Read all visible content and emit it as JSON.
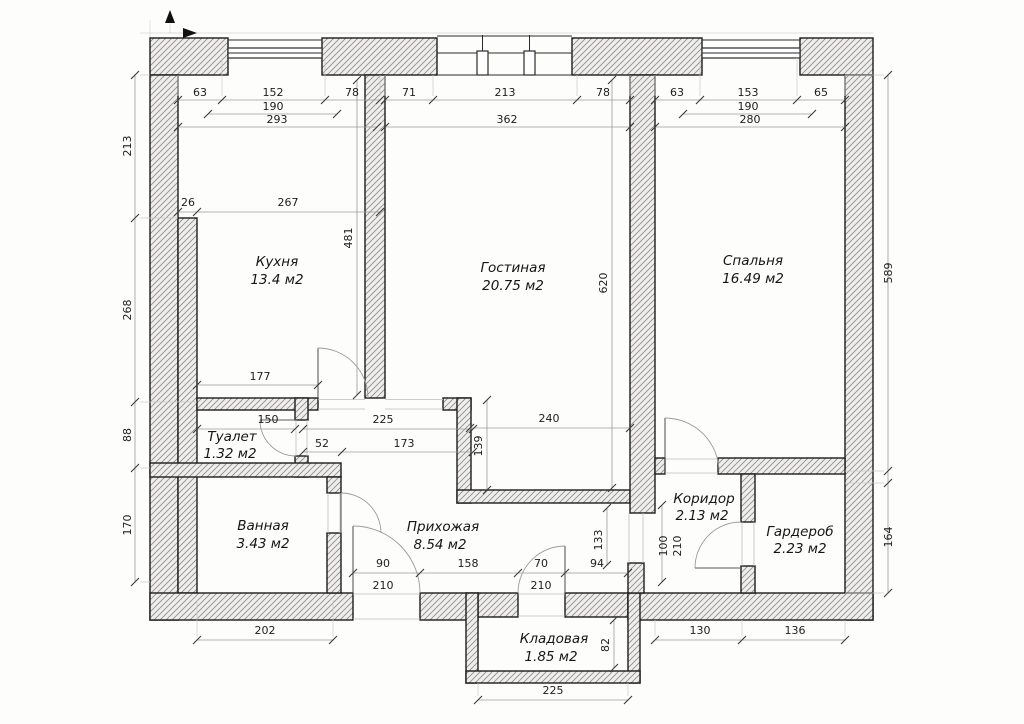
{
  "rooms": {
    "kitchen": {
      "name": "Кухня",
      "area": "13.4 м2"
    },
    "living": {
      "name": "Гостиная",
      "area": "20.75 м2"
    },
    "bedroom": {
      "name": "Спальня",
      "area": "16.49 м2"
    },
    "toilet": {
      "name": "Туалет",
      "area": "1.32 м2"
    },
    "bath": {
      "name": "Ванная",
      "area": "3.43 м2"
    },
    "hall": {
      "name": "Прихожая",
      "area": "8.54 м2"
    },
    "corridor": {
      "name": "Коридор",
      "area": "2.13 м2"
    },
    "wardrobe": {
      "name": "Гардероб",
      "area": "2.23 м2"
    },
    "pantry": {
      "name": "Кладовая",
      "area": "1.85 м2"
    }
  },
  "dims": {
    "kitchen_top": {
      "a": "63",
      "b": "152",
      "c": "78",
      "frame": "190",
      "total": "293"
    },
    "living_top": {
      "a": "71",
      "b": "213",
      "c": "78",
      "total": "362"
    },
    "bedroom_top": {
      "a": "63",
      "b": "153",
      "c": "65",
      "frame": "190",
      "total": "280"
    },
    "left": {
      "a": "213",
      "b": "268",
      "c": "88",
      "d": "170"
    },
    "right": {
      "a": "589",
      "b": "164"
    },
    "kitchen_in": {
      "a": "26",
      "b": "267",
      "h": "481",
      "w": "177"
    },
    "living_in": {
      "h": "620",
      "w": "240",
      "n": "139"
    },
    "mid": {
      "toilet_w": "150",
      "pass": "225",
      "a": "52",
      "b": "173"
    },
    "hall": {
      "door_w": "90",
      "door_h": "210",
      "a": "158",
      "pantry_door_w": "70",
      "pantry_door_h": "210",
      "b": "94",
      "n": "133"
    },
    "corridor": {
      "a": "100",
      "b": "210"
    },
    "bottom": {
      "a": "202",
      "b": "130",
      "c": "136",
      "pantry_w": "225",
      "pantry_h": "82"
    }
  }
}
